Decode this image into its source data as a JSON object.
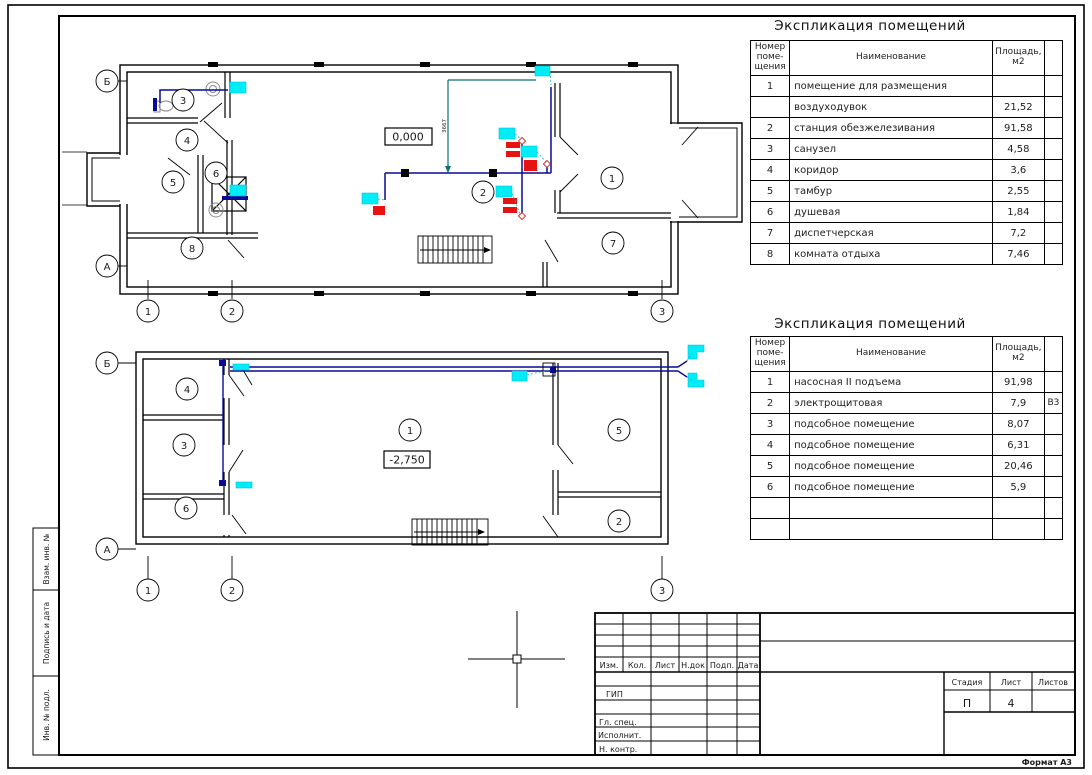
{
  "sheet": {
    "format_label": "Формат А3",
    "margin_stamps": [
      {
        "label": "Взам. инв. №"
      },
      {
        "label": "Подпись и дата"
      },
      {
        "label": "Инв. № подл."
      }
    ]
  },
  "colors": {
    "wire_blue": "#0a0a96",
    "riser_teal": "#0e6e6e",
    "device_cyan": "#00ecf7",
    "device_red": "#e81212"
  },
  "icons": {
    "cad_crosshair_cursor": "+"
  },
  "explication_upper": {
    "title": "Экспликация помещений",
    "col_num": "Номер\nпоме-\nщения",
    "col_name": "Наименование",
    "col_area": "Площадь,\nм2",
    "rows": [
      {
        "num": "1",
        "name": "помещение для размещения",
        "area": "",
        "note": ""
      },
      {
        "num": "",
        "name": "воздуходувок",
        "area": "21,52",
        "note": ""
      },
      {
        "num": "2",
        "name": "станция обезжелезивания",
        "area": "91,58",
        "note": ""
      },
      {
        "num": "3",
        "name": "санузел",
        "area": "4,58",
        "note": ""
      },
      {
        "num": "4",
        "name": "коридор",
        "area": "3,6",
        "note": ""
      },
      {
        "num": "5",
        "name": "тамбур",
        "area": "2,55",
        "note": ""
      },
      {
        "num": "6",
        "name": "душевая",
        "area": "1,84",
        "note": ""
      },
      {
        "num": "7",
        "name": "диспетчерская",
        "area": "7,2",
        "note": ""
      },
      {
        "num": "8",
        "name": "комната отдыха",
        "area": "7,46",
        "note": ""
      }
    ]
  },
  "explication_lower": {
    "title": "Экспликация помещений",
    "col_num": "Номер\nпоме-\nщения",
    "col_name": "Наименование",
    "col_area": "Площадь,\nм2",
    "rows": [
      {
        "num": "1",
        "name": "насосная II подъема",
        "area": "91,98",
        "note": ""
      },
      {
        "num": "2",
        "name": "электрощитовая",
        "area": "7,9",
        "note": "В3"
      },
      {
        "num": "3",
        "name": "подсобное помещение",
        "area": "8,07",
        "note": ""
      },
      {
        "num": "4",
        "name": "подсобное помещение",
        "area": "6,31",
        "note": ""
      },
      {
        "num": "5",
        "name": "подсобное помещение",
        "area": "20,46",
        "note": ""
      },
      {
        "num": "6",
        "name": "подсобное помещение",
        "area": "5,9",
        "note": ""
      },
      {
        "num": "",
        "name": "",
        "area": "",
        "note": ""
      },
      {
        "num": "",
        "name": "",
        "area": "",
        "note": ""
      }
    ]
  },
  "title_block": {
    "rev_cols": [
      "Изм.",
      "Кол.",
      "Лист",
      "Н.док",
      "Подп.",
      "Дата"
    ],
    "roles": [
      "ГИП",
      "Гл. спец.",
      "Исполнит.",
      "Н. контр."
    ],
    "stage_label": "Стадия",
    "sheet_label": "Лист",
    "sheets_label": "Листов",
    "stage_value": "П",
    "sheet_value": "4",
    "sheets_value": ""
  },
  "plan_upper": {
    "elevation": "0,000",
    "riser_dim": "3667",
    "axes": {
      "b": "Б",
      "a": "А",
      "c1": "1",
      "c2": "2",
      "c3": "3"
    },
    "rooms": {
      "r1": "1",
      "r2": "2",
      "r3": "3",
      "r4": "4",
      "r5": "5",
      "r6": "6",
      "r7": "7",
      "r8": "8"
    }
  },
  "plan_lower": {
    "elevation": "-2,750",
    "axes": {
      "b": "Б",
      "a": "А",
      "c1": "1",
      "c2": "2",
      "c3": "3"
    },
    "rooms": {
      "r1": "1",
      "r2": "2",
      "r3": "3",
      "r4": "4",
      "r5": "5",
      "r6": "6"
    }
  }
}
